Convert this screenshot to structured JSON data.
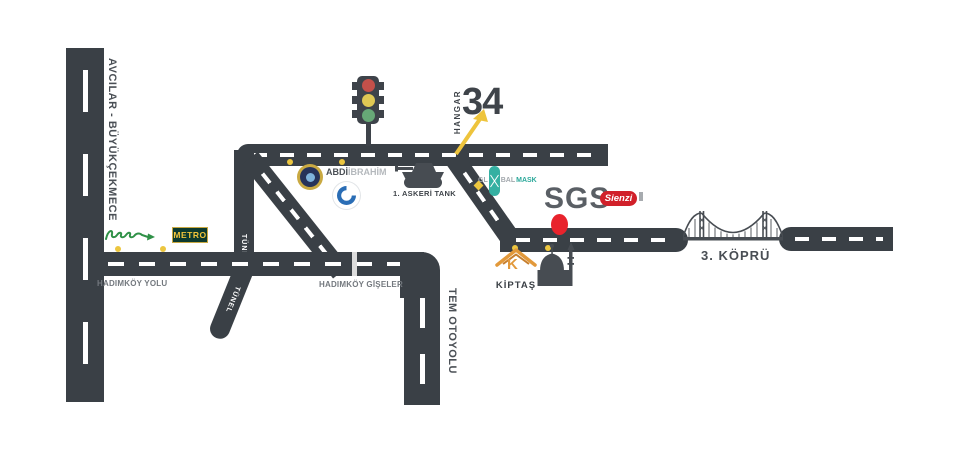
{
  "canvas": {
    "width": 956,
    "height": 462,
    "background": "#ffffff"
  },
  "colors": {
    "road": "#3a4046",
    "dash": "#ffffff",
    "label_dark": "#4a4f55",
    "label_light": "#73787e",
    "accent_yellow": "#ecc63f",
    "marker_red": "#e8232c",
    "teal": "#35b0a2",
    "kiptas_orange": "#e2993b",
    "script_logo_green": "#2f9147",
    "metro_bg": "#0d3a2e",
    "metro_text": "#f2c53a",
    "sienzi_red": "#d1202a"
  },
  "labels": {
    "avcilar": "AVCILAR - BÜYÜKÇEKMECE",
    "hadimkoy_yolu": "HADIMKÖY YOLU",
    "tunel_vertical": "TÜNEL",
    "tunel_diagonal": "TÜNEL",
    "hadimkoy_giseler": "HADIMKÖY GİŞELER",
    "tem_otoyolu": "TEM OTOYOLU",
    "kopru": "3. KÖPRÜ",
    "askeri_tank": "1. ASKERİ TANK"
  },
  "logos": {
    "metro": "METRO",
    "abdi_bold": "ABDİ",
    "abdi_light": "İBRAHİM",
    "globalmask_p1": "GL",
    "globalmask_p2": "BAL",
    "globalmask_p3": "MASK",
    "sgs": "SGS",
    "sienzi": "Sienzi",
    "kiptas": "KİPTAŞ",
    "kiptas_k": "K",
    "hangar_word": "HANGAR",
    "hangar_number": "34"
  }
}
